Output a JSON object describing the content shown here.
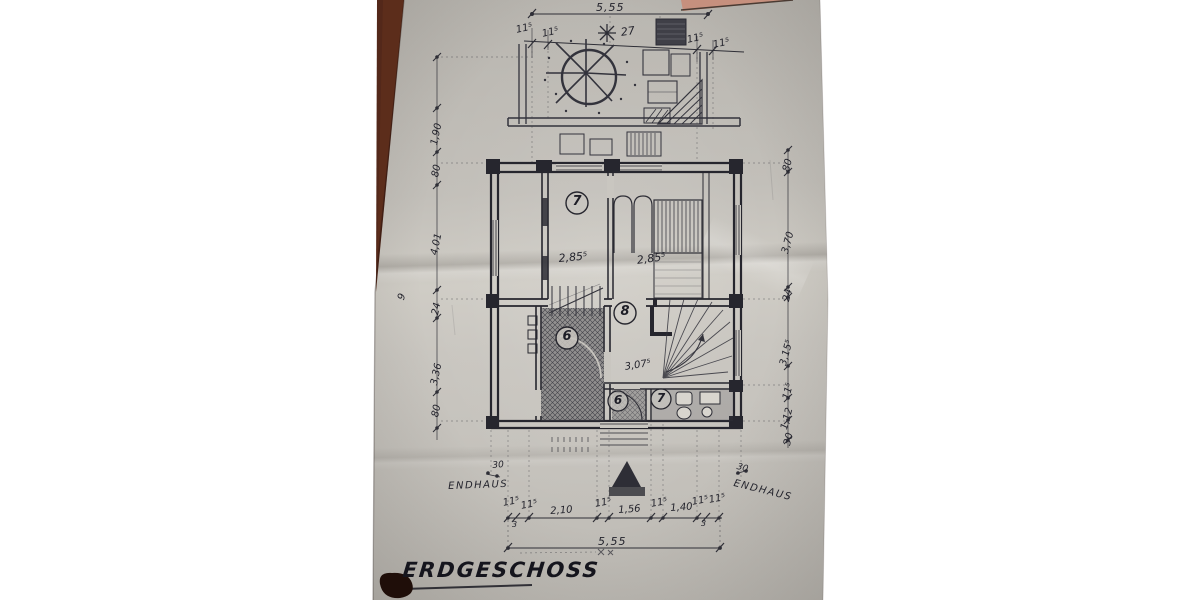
{
  "title": "ERDGESCHOSS",
  "rooms": {
    "bedroom": "7",
    "hall": "8",
    "kitchen": "6",
    "lobby": "6",
    "bath": "7"
  },
  "labels": {
    "endhaus_left": "ENDHAUS",
    "endhaus_right": "ENDHAUS",
    "edge_mark": "9"
  },
  "dims": {
    "top_total": "5,55",
    "top_11a": "11⁵",
    "top_11b": "11⁵",
    "tree": "27",
    "top_11c": "11⁵",
    "top_11d": "11⁵",
    "left": [
      "1,90",
      "80",
      "4,01",
      "24",
      "3,36",
      "80"
    ],
    "right": [
      "80",
      "3,70",
      "24",
      "3,15⁵",
      "11⁵",
      "1,12",
      "30"
    ],
    "bottom": [
      "11⁵",
      "3",
      "11⁵",
      "2,10",
      "11⁵",
      "1,56",
      "11⁵",
      "1,40",
      "11⁵",
      "3",
      "11⁵"
    ],
    "bottom_total": "5,55",
    "interior": {
      "room_a": "2,85⁵",
      "room_b": "2,85⁵",
      "hall": "3,07⁵",
      "step_left": "30",
      "step_right": "30"
    }
  },
  "colors": {
    "paper": "#c6c3bc",
    "ink": "#2b2b34",
    "wood_dark": "#53281a",
    "wood_light": "#c6907e"
  }
}
